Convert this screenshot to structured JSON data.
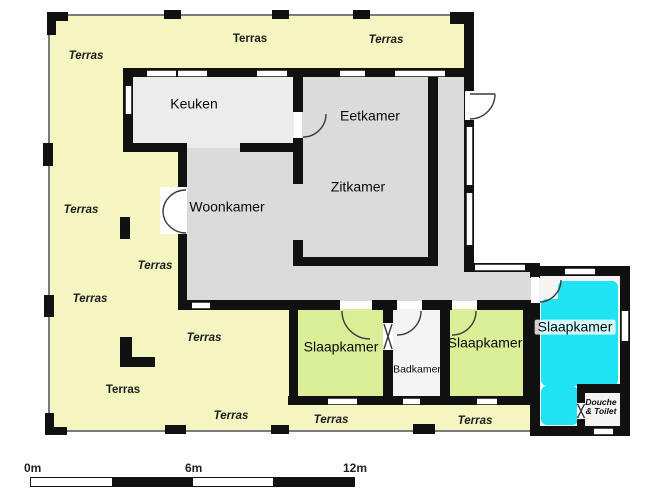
{
  "plan_title": "floor-plan",
  "colors": {
    "terrace_yellow": "#f5f5c2",
    "room_gray": "#dbdbdb",
    "kitchen_gray": "#ececec",
    "bedroom_green": "#d9ee97",
    "bedroom_cyan": "#1fe2f3",
    "white_room": "#f4f4f4",
    "wall_black": "#111111",
    "boundary_gray": "#7a7a7a"
  },
  "room_labels": [
    {
      "id": "keuken",
      "text": "Keuken",
      "x": 194,
      "y": 104,
      "cls": "room"
    },
    {
      "id": "eetkamer",
      "text": "Eetkamer",
      "x": 370,
      "y": 116,
      "cls": "room"
    },
    {
      "id": "zitkamer",
      "text": "Zitkamer",
      "x": 358,
      "y": 187,
      "cls": "room"
    },
    {
      "id": "woonkamer",
      "text": "Woonkamer",
      "x": 227,
      "y": 207,
      "cls": "room"
    },
    {
      "id": "slaapkamer-1",
      "text": "Slaapkamer",
      "x": 341,
      "y": 347,
      "cls": "room"
    },
    {
      "id": "badkamer",
      "text": "Badkamer",
      "x": 417,
      "y": 370,
      "cls": "small"
    },
    {
      "id": "slaapkamer-2",
      "text": "Slaapkamer",
      "x": 485,
      "y": 343,
      "cls": "room"
    },
    {
      "id": "slaapkamer-3",
      "text": "Slaapkamer",
      "x": 575,
      "y": 327,
      "cls": "room halo"
    },
    {
      "id": "douche-toilet",
      "text": "Douche\n& Toilet",
      "x": 601,
      "y": 407,
      "cls": "tiny"
    }
  ],
  "terras_text": "Terras",
  "terras_labels": [
    {
      "x": 86,
      "y": 56,
      "italic": true
    },
    {
      "x": 250,
      "y": 39,
      "italic": false
    },
    {
      "x": 386,
      "y": 40,
      "italic": true
    },
    {
      "x": 81,
      "y": 210,
      "italic": true
    },
    {
      "x": 155,
      "y": 266,
      "italic": true
    },
    {
      "x": 90,
      "y": 299,
      "italic": true
    },
    {
      "x": 204,
      "y": 338,
      "italic": true
    },
    {
      "x": 123,
      "y": 390,
      "italic": false
    },
    {
      "x": 231,
      "y": 416,
      "italic": true
    },
    {
      "x": 331,
      "y": 420,
      "italic": true
    },
    {
      "x": 475,
      "y": 421,
      "italic": true
    }
  ],
  "scale_bar": {
    "labels": [
      "0m",
      "6m",
      "12m"
    ]
  }
}
